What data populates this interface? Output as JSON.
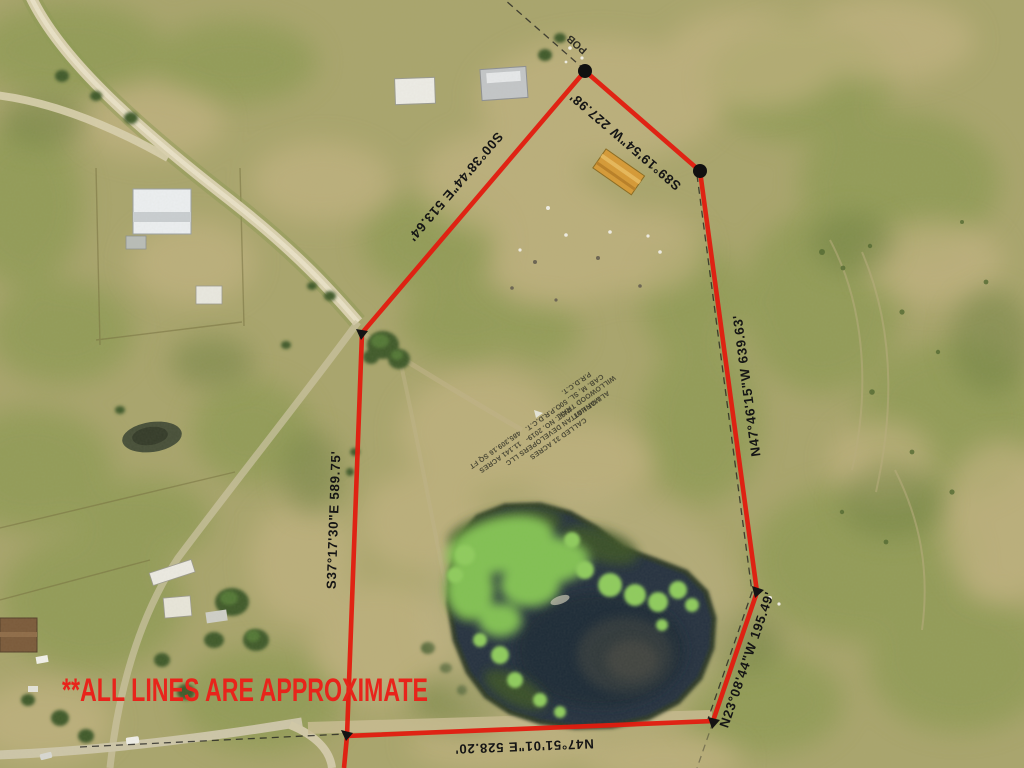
{
  "title": "Aerial property boundary photo",
  "disclaimer": {
    "text": "**ALL LINES ARE APPROXIMATE",
    "color": "#e8241b"
  },
  "boundary": {
    "color": "#e11b0f",
    "pob_label": "POB",
    "segments": [
      {
        "id": "north",
        "bearing": "S89°19'54\"W",
        "distance": "227.98'",
        "label": "S89°19'54\"W  227.98'"
      },
      {
        "id": "northwest",
        "bearing": "S00°38'44\"E",
        "distance": "513.64'",
        "label": "S00°38'44\"E  513.64'"
      },
      {
        "id": "east",
        "bearing": "N47°46'15\"W",
        "distance": "639.63'",
        "label": "N47°46'15\"W  639.63'"
      },
      {
        "id": "west",
        "bearing": "S37°17'30\"E",
        "distance": "589.75'",
        "label": "S37°17'30\"E  589.75'"
      },
      {
        "id": "southeast",
        "bearing": "N23°08'44\"W",
        "distance": "195.49'",
        "label": "N23°08'44\"W  195.49'"
      },
      {
        "id": "south",
        "bearing": "N47°51'01\"E",
        "distance": "528.20'",
        "label": "N47°51'01\"E  528.20'"
      }
    ]
  },
  "parcel_notes": {
    "area": "11.141 ACRES\n485,309.16 SQ FT",
    "deed": "CALLED 31 ACRES\nMANHATTAN DEVELOPERS LLC\nINST. NO. 2019-\nO.P.R.D.C.T.",
    "plat": "ALL OF LOT\nWILLOWOOD TRAIL\nCAB. M, SL. 50\nP.R.D.C.T."
  }
}
